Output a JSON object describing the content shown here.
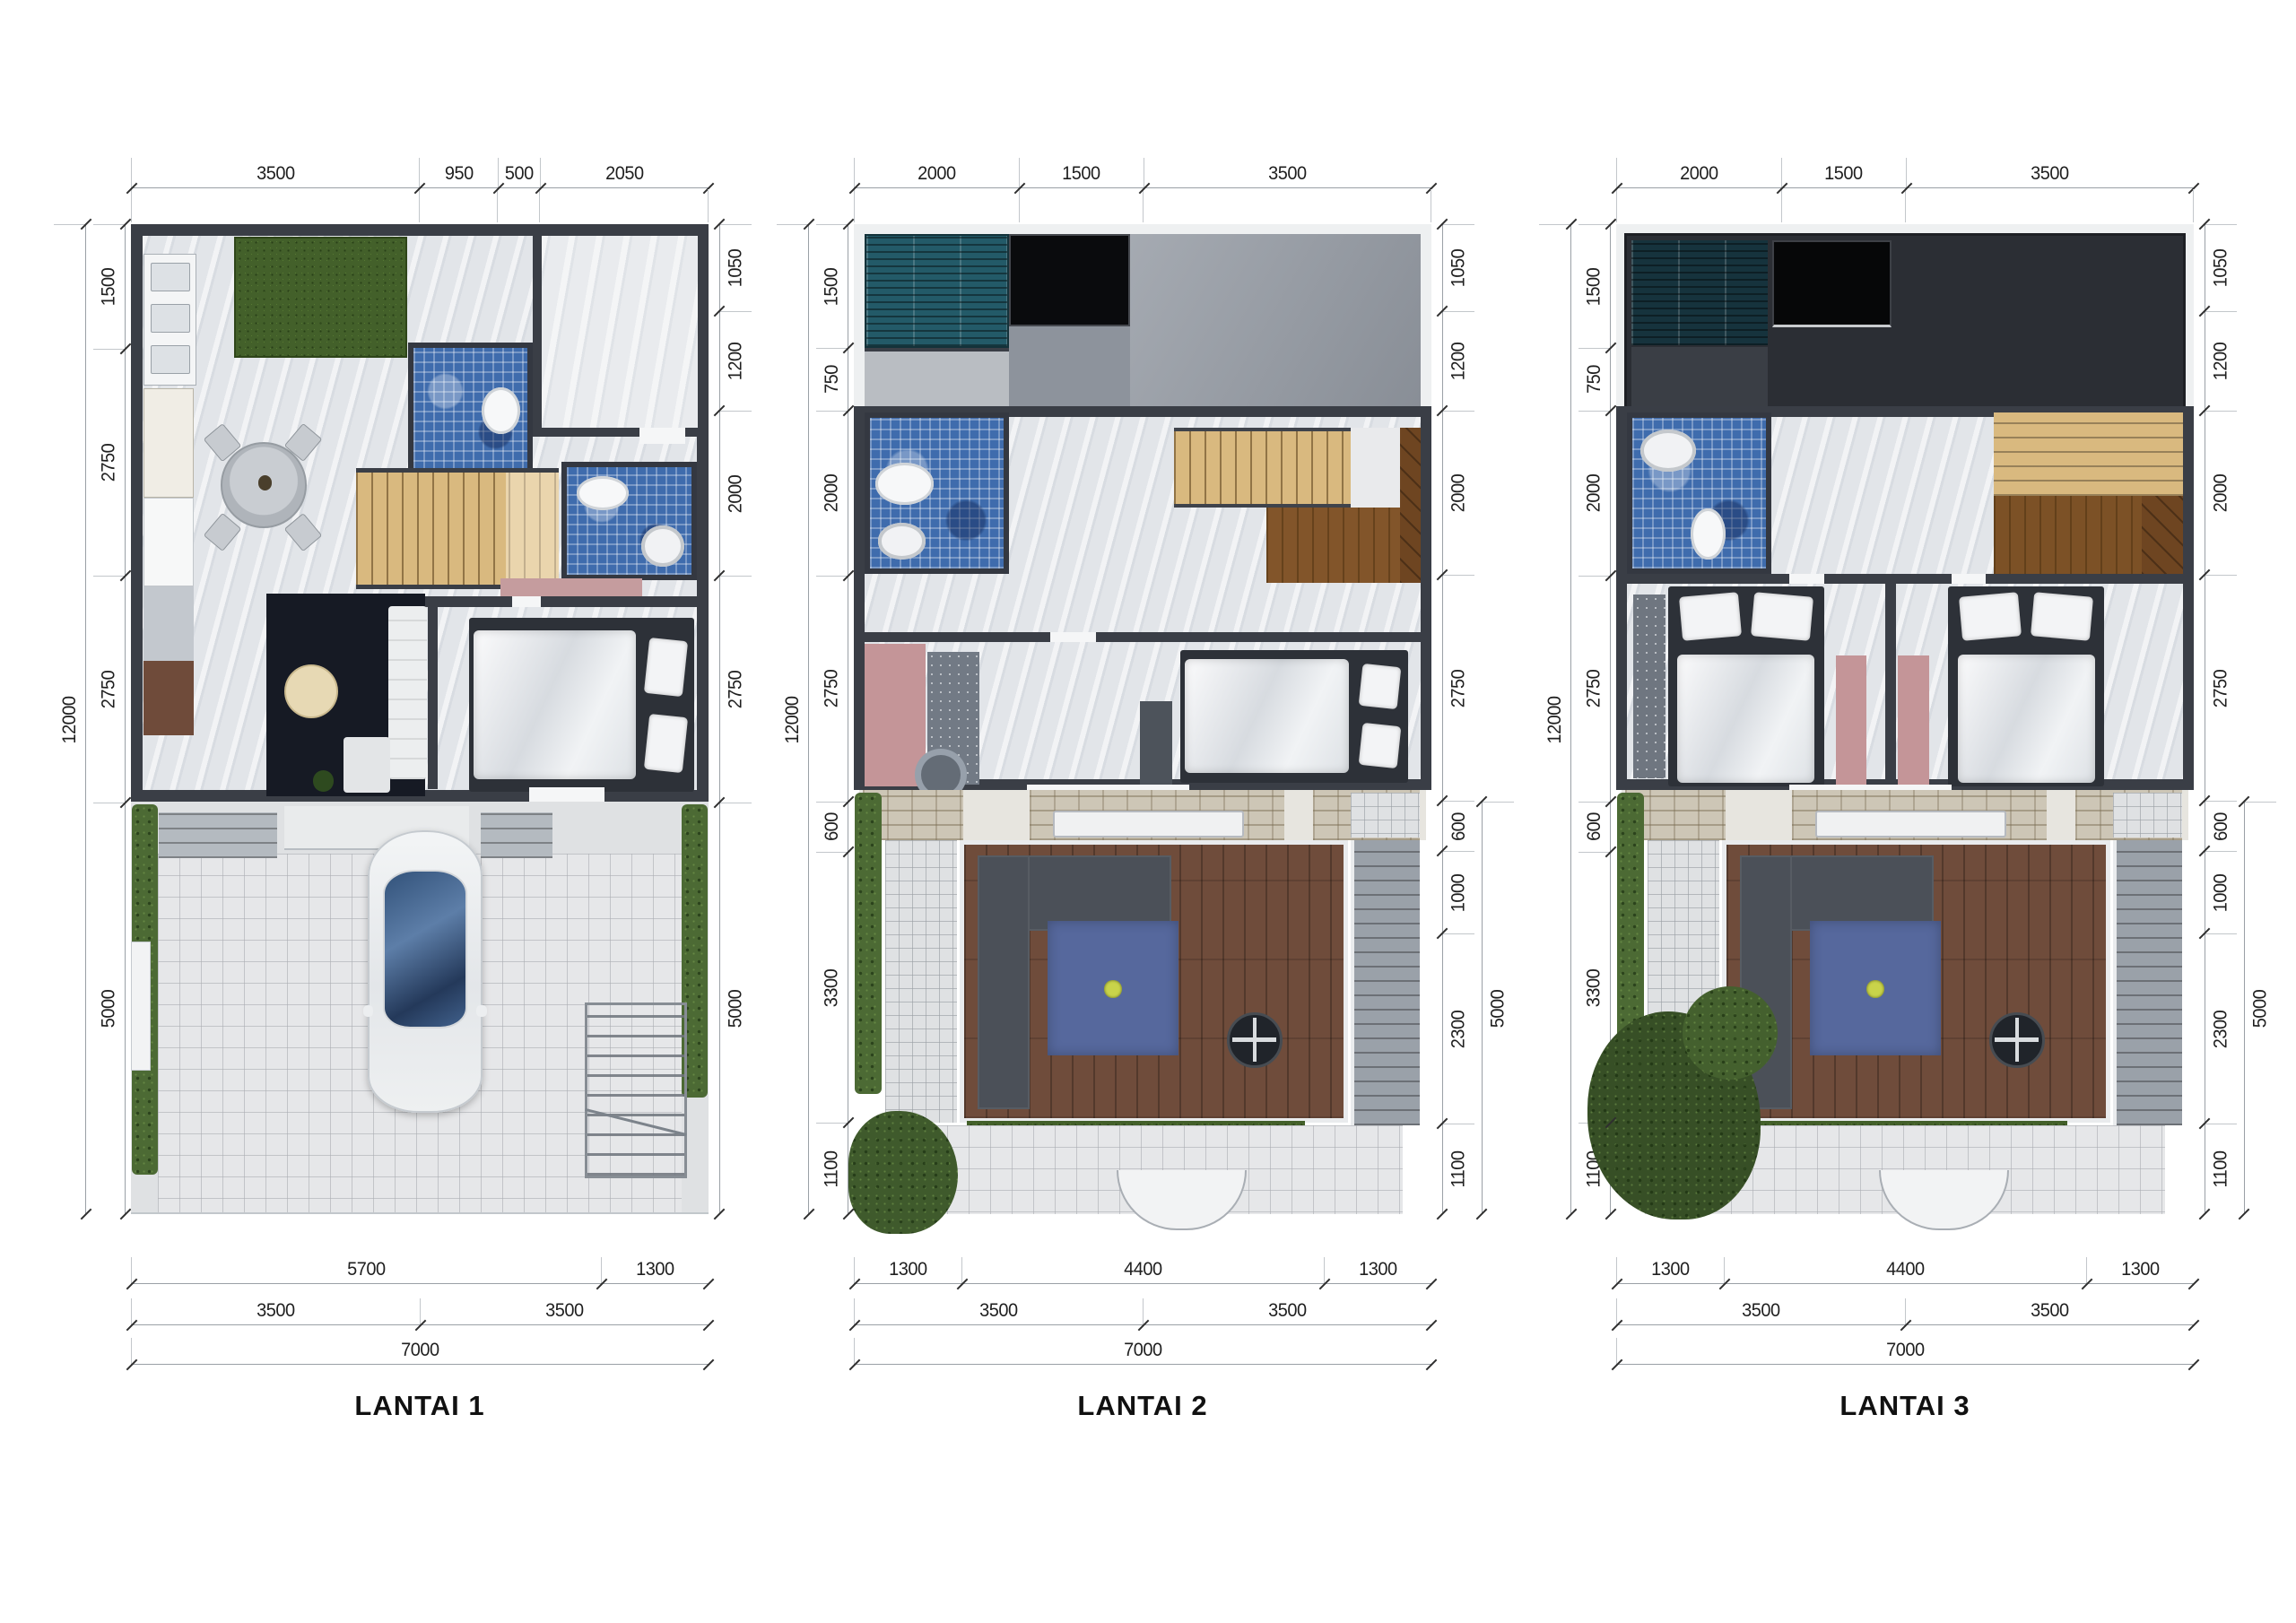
{
  "page_background": "#ffffff",
  "plans": [
    {
      "label": "LANTAI 1",
      "dims": {
        "top": [
          "3500",
          "950",
          "500",
          "2050"
        ],
        "left_overall": [
          "12000"
        ],
        "left": [
          "1500",
          "2750",
          "2750",
          "5000"
        ],
        "right": [
          "1050",
          "1200",
          "2000",
          "2750",
          "5000"
        ],
        "bottom1": [
          "5700",
          "1300"
        ],
        "bottom2": [
          "3500",
          "3500"
        ],
        "bottom3": [
          "7000"
        ]
      }
    },
    {
      "label": "LANTAI 2",
      "dims": {
        "top": [
          "2000",
          "1500",
          "3500"
        ],
        "left_overall": [
          "12000"
        ],
        "left": [
          "1500",
          "750",
          "2000",
          "2750",
          "600",
          "3300",
          "1100"
        ],
        "right": [
          "1050",
          "1200",
          "2000",
          "2750",
          "600",
          "1000",
          "2300",
          "1100"
        ],
        "right_overall": [
          "5000"
        ],
        "bottom1": [
          "1300",
          "4400",
          "1300"
        ],
        "bottom2": [
          "3500",
          "3500"
        ],
        "bottom3": [
          "7000"
        ]
      }
    },
    {
      "label": "LANTAI 3",
      "dims": {
        "top": [
          "2000",
          "1500",
          "3500"
        ],
        "left_overall": [
          "12000"
        ],
        "left": [
          "1500",
          "750",
          "2000",
          "2750",
          "600",
          "3300",
          "1100"
        ],
        "right": [
          "1050",
          "1200",
          "2000",
          "2750",
          "600",
          "1000",
          "2300",
          "1100"
        ],
        "right_overall": [
          "5000"
        ],
        "bottom1": [
          "1300",
          "4400",
          "1300"
        ],
        "bottom2": [
          "3500",
          "3500"
        ],
        "bottom3": [
          "7000"
        ]
      }
    }
  ],
  "palette": {
    "wall": "#3a3e46",
    "mosaic_blue": "#3f6cad",
    "skylight_teal": "#235a68",
    "stair_wood": "#d9b97f",
    "stair_wood_dark": "#82552a",
    "deck_wood": "#6f4c3b",
    "hedge_green": "#4c6a34",
    "rug_pink": "#c49598",
    "rug_navy": "#161a24",
    "rug_blue": "#56689d",
    "roof_dark": "#2b2e34",
    "roof_gray": "#949aa3"
  }
}
